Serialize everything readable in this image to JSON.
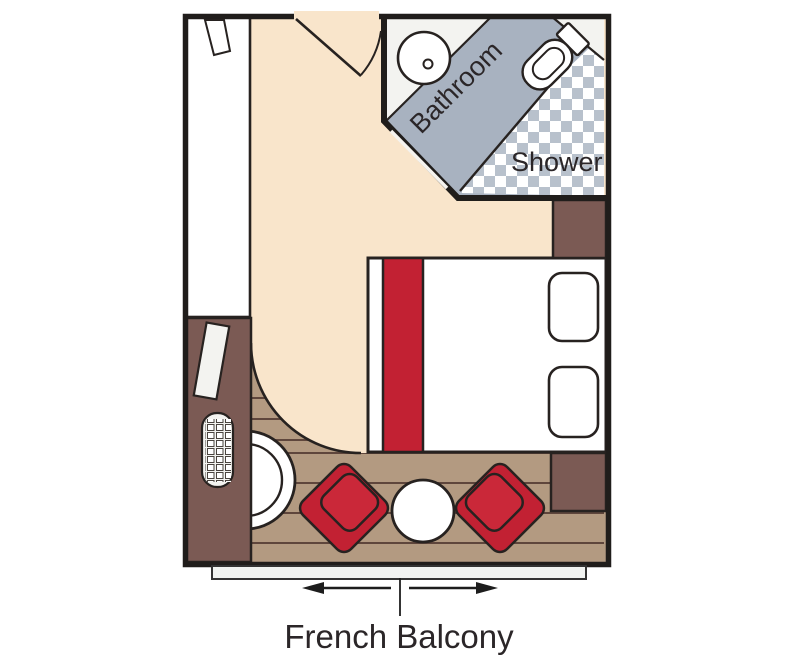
{
  "labels": {
    "bathroom": "Bathroom",
    "shower": "Shower",
    "french_balcony": "French Balcony"
  },
  "colors": {
    "carpet": "#f9e5cb",
    "deck_wood": "#b39a81",
    "plank_line": "#5f463c",
    "furniture_brown": "#7b5a54",
    "accent_red": "#c22133",
    "accent_red2": "#ca2839",
    "bathroom_floor": "#a8b2c0",
    "checker_gray": "#b8c1cc",
    "vanity_white": "#f3f3f0",
    "wall": "#201d1b",
    "outline": "#272220",
    "rail_fill": "#f1f3f1",
    "label_dark": "#2b2628"
  }
}
